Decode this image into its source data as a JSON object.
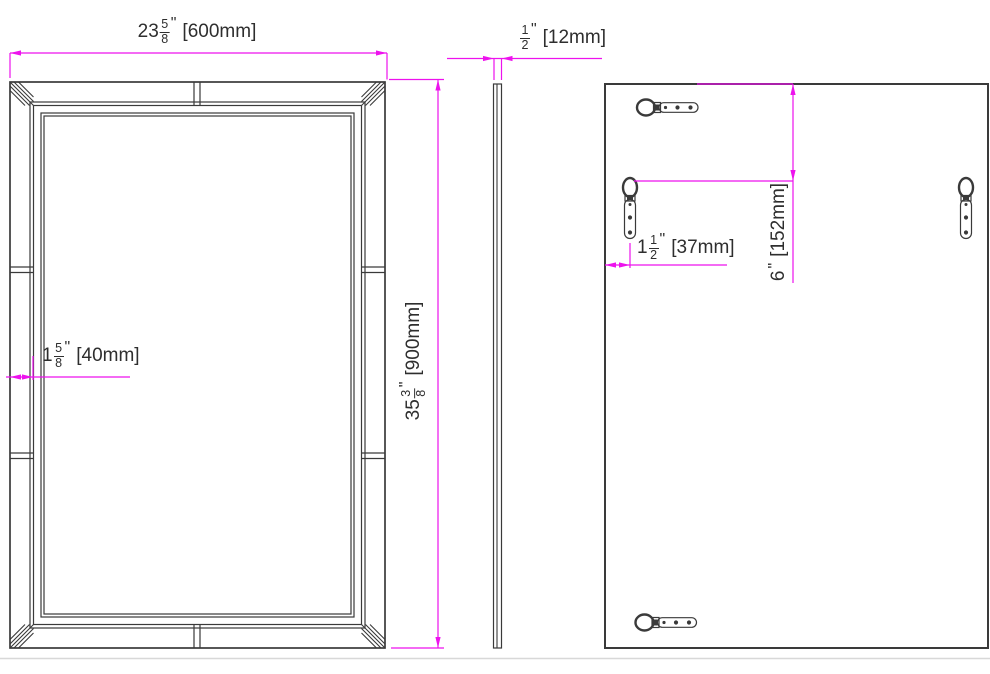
{
  "drawing": {
    "type": "technical-drawing",
    "subject": "rectangular beveled wall mirror - front, side and back views",
    "colors": {
      "dimension_line": "#ED12ED",
      "drawing_line": "#3a3a3a",
      "background": "#ffffff"
    },
    "components": {
      "front_view": "mirror-front-frame",
      "side_view": "mirror-side-profile",
      "back_view": "mirror-back-panel",
      "hanger_top_left": "keyhole-hanger-horizontal",
      "hanger_bottom_left": "keyhole-hanger-horizontal",
      "hanger_left": "d-ring-hanger-vertical",
      "hanger_right": "d-ring-hanger-vertical"
    },
    "dimensions": {
      "width": {
        "whole": "23",
        "num": "5",
        "den": "8",
        "unit": "\"",
        "metric": "[600mm]",
        "full": "23 5/8\" [600mm]"
      },
      "thickness": {
        "whole": "",
        "num": "1",
        "den": "2",
        "unit": "\"",
        "metric": "[12mm]",
        "full": "1/2\" [12mm]"
      },
      "frame_width": {
        "whole": "1",
        "num": "5",
        "den": "8",
        "unit": "\"",
        "metric": "[40mm]",
        "full": "1 5/8\" [40mm]"
      },
      "height": {
        "whole": "35",
        "num": "3",
        "den": "8",
        "unit": "\"",
        "metric": "[900mm]",
        "full": "35 3/8\" [900mm]"
      },
      "hanger_inset": {
        "whole": "1",
        "num": "1",
        "den": "2",
        "unit": "\"",
        "metric": "[37mm]",
        "full": "1 1/2\" [37mm]"
      },
      "hanger_drop": {
        "whole": "6",
        "num": "",
        "den": "",
        "unit": "\"",
        "metric": "[152mm]",
        "full": "6\" [152mm]"
      }
    }
  }
}
